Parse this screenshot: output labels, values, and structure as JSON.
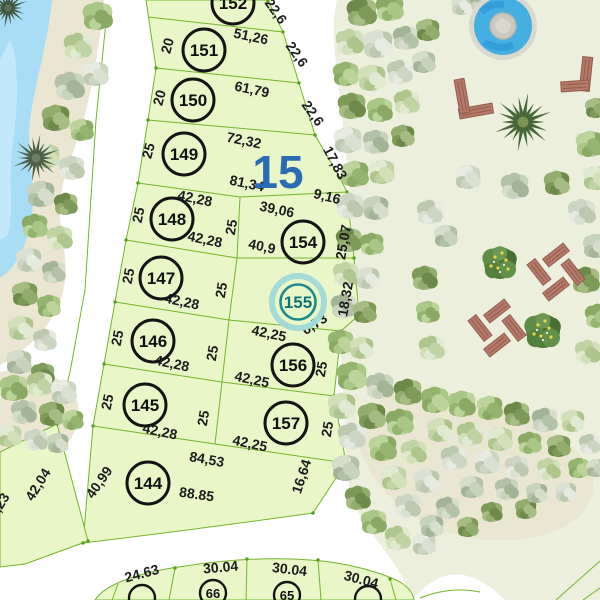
{
  "block": {
    "number": "15"
  },
  "selected_plot": "155",
  "colors": {
    "plot_fill": "#e9f7c8",
    "boundary_line": "#74b42c",
    "block_number_blue": "#2a6cb4",
    "highlight_teal": "#1d8a8e",
    "pool_water": "#45aee3",
    "pond_water": "#a9ddf5",
    "park_ground": "#ecefdc",
    "sand": "#eae6d1",
    "bench_brown": "#b5796a"
  },
  "plots": {
    "152": {
      "number": "152",
      "side_top": "22,6"
    },
    "151": {
      "number": "151",
      "width": "20",
      "length": "51,26",
      "side": "22,6"
    },
    "150": {
      "number": "150",
      "width": "20",
      "length": "61,79",
      "side": "22,6"
    },
    "149": {
      "number": "149",
      "width": "25",
      "length_top": "72,32",
      "length_bottom": "81,34",
      "side": "17,83",
      "side2": "9,16"
    },
    "148": {
      "number": "148",
      "width": "25",
      "length_top": "42,28",
      "length_bottom": "42,28",
      "spine": "25"
    },
    "147": {
      "number": "147",
      "width": "25",
      "length_bottom": "42,28",
      "spine": "25"
    },
    "146": {
      "number": "146",
      "width": "25",
      "length_bottom": "42,28",
      "spine": "25"
    },
    "145": {
      "number": "145",
      "width": "25",
      "length_bottom": "42,28",
      "spine": "25"
    },
    "144": {
      "number": "144",
      "side_left": "40,99",
      "length_top": "84,53",
      "length_bottom": "88.85",
      "side_right": "16,64"
    },
    "154": {
      "number": "154",
      "length_top": "39,06",
      "length_bottom": "40,9",
      "side": "25,07"
    },
    "155": {
      "number": "155",
      "side": "18,32",
      "side_bottom": "6,73"
    },
    "156": {
      "number": "156",
      "length_top": "42,25",
      "length_bottom": "42,25",
      "side": "25"
    },
    "157": {
      "number": "157",
      "length_bottom": "42,25",
      "side": "25"
    }
  },
  "west_plot": {
    "edge": "42,04",
    "edge_partial": ",23"
  },
  "bottom_row": {
    "left_width": "24.63",
    "plots": [
      {
        "number": "66",
        "width": "30.04"
      },
      {
        "number": "65",
        "width": "30.04"
      }
    ],
    "right_width": "30.04"
  }
}
